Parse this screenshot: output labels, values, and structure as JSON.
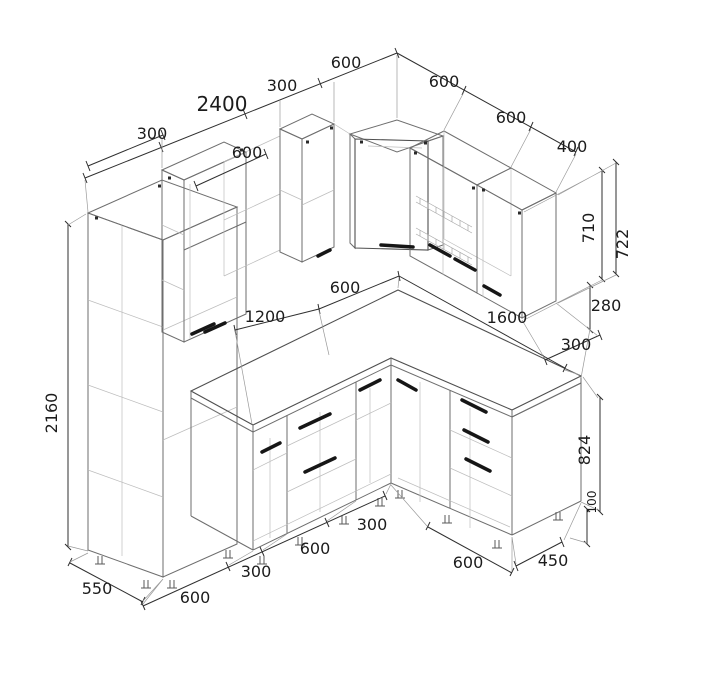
{
  "drawing": {
    "background": "#ffffff",
    "colors": {
      "cabinet_line": "#6e6e6e",
      "hidden_line": "#bdbdbd",
      "dimension_line": "#2f2f2f",
      "handle": "#161616",
      "label_text": "#1c1c1c"
    }
  },
  "dims": {
    "pantry_top_300": "300",
    "left_wall_total_2400": "2400",
    "left_upper_seg_300": "300",
    "left_upper_seg_600": "600",
    "wall_cabinet_600": "600",
    "right_wall_seg1_600": "600",
    "right_wall_seg2_600": "600",
    "right_wall_seg3_400": "400",
    "wall_cab_height_710": "710",
    "wall_total_height_722": "722",
    "gap_280": "280",
    "wall_depth_300": "300",
    "counter_corner_600": "600",
    "counter_left_1200": "1200",
    "counter_right_1600": "1600",
    "pantry_height_2160": "2160",
    "pantry_depth_550": "550",
    "base_seg_600_a": "600",
    "base_seg_300_a": "300",
    "base_seg_600_b": "600",
    "base_seg_300_b": "300",
    "base_right_600": "600",
    "base_right_450": "450",
    "base_height_824": "824",
    "plinth_height_100": "100"
  }
}
